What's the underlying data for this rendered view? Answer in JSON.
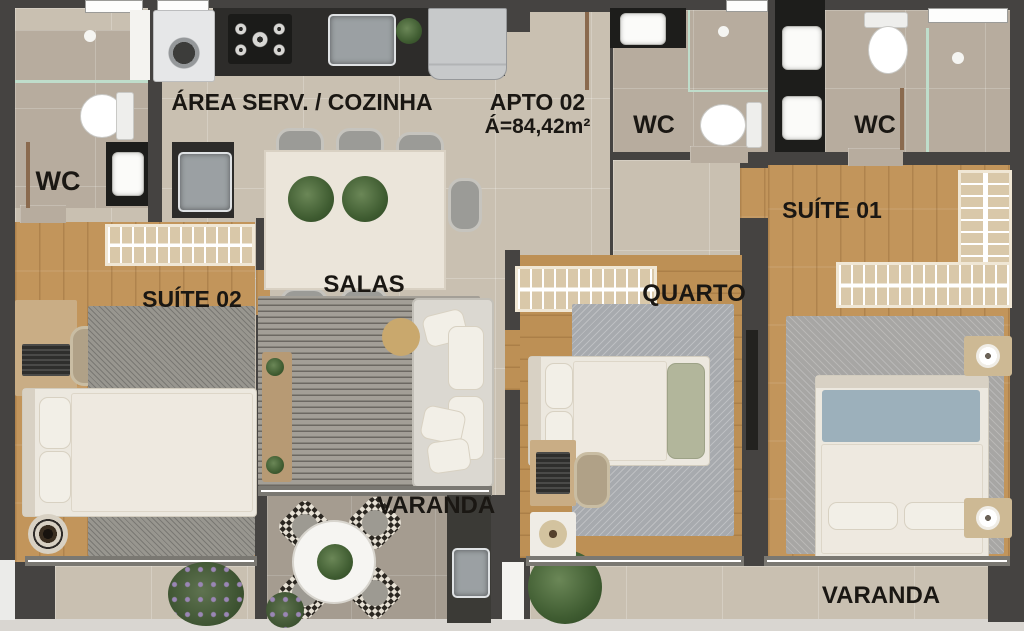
{
  "floorplan": {
    "apartment": {
      "name": "APTO 02",
      "area": "Á=84,42m²"
    },
    "rooms": {
      "area_servico_cozinha": {
        "label": "ÁREA SERV. / COZINHA"
      },
      "wc_social": {
        "label": "WC"
      },
      "wc_meio": {
        "label": "WC"
      },
      "wc_suite": {
        "label": "WC"
      },
      "suite_01": {
        "label": "SUÍTE 01"
      },
      "suite_02": {
        "label": "SUÍTE 02"
      },
      "salas": {
        "label": "SALAS"
      },
      "quarto": {
        "label": "QUARTO"
      },
      "varanda_social": {
        "label": "VARANDA"
      },
      "varanda_suite": {
        "label": "VARANDA"
      }
    },
    "colors": {
      "wall": "#454341",
      "tile_floor": "#c9c0b1",
      "bath_floor": "#b7ac9e",
      "wood_floor": "#c2955b",
      "varanda_floor": "#a59c90",
      "counter_dark": "#2d2c2a",
      "label_text": "#1a1713"
    }
  }
}
